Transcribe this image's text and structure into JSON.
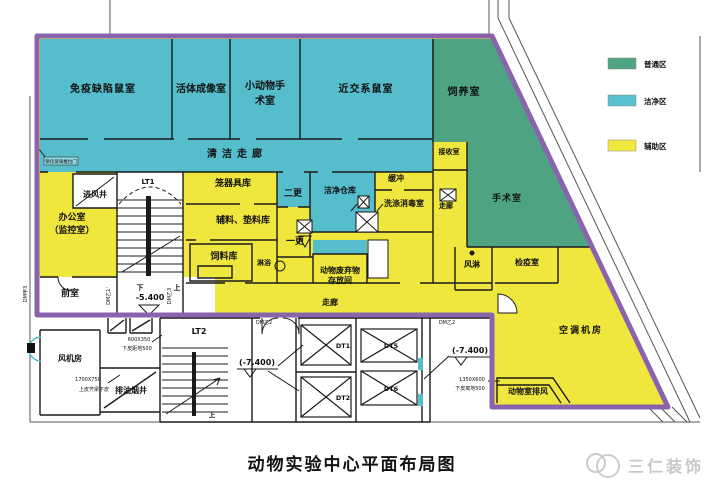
{
  "colors": {
    "boundary": "#8A63AD",
    "clean": "#55BDCB",
    "general": "#4EA383",
    "auxiliary": "#F0E73E",
    "wall": "#1a1a1a"
  },
  "legend": {
    "items": [
      {
        "label": "普通区",
        "color": "#4FA583"
      },
      {
        "label": "洁净区",
        "color": "#56C1CF"
      },
      {
        "label": "辅助区",
        "color": "#F2E83B"
      }
    ]
  },
  "title": "动物实验中心平面布局图",
  "watermark": "三仁装饰",
  "rooms": {
    "immuno": "免疫缺陷鼠室",
    "imaging": "活体成像室",
    "small_surgery_1": "小动物手",
    "small_surgery_2": "术室",
    "inbred": "近交系鼠室",
    "breeding": "饲养室",
    "clean_corridor": "清洁走廊",
    "receiving": "接收室",
    "air_inlet": "进风井",
    "office_1": "办公室",
    "office_2": "（监控室）",
    "cage_store": "笼器具库",
    "second_change": "二更",
    "clean_warehouse": "洁净仓库",
    "buffer": "缓冲",
    "washing": "洗涤消毒室",
    "corridor_recv": "走廊",
    "surgery": "手术室",
    "materials": "辅料、垫料库",
    "first_change": "一更",
    "feed_store": "饲料库",
    "shower": "淋浴",
    "waste_1": "动物废弃物",
    "waste_2": "存放间",
    "air_shower": "风淋",
    "quarantine": "检疫室",
    "corridor_main": "走廊",
    "anteroom": "前室",
    "ac_room": "空调机房",
    "animal_exhaust": "动物室排风",
    "fan_room": "风机房",
    "oil_shaft": "排油烟井",
    "lt1": "LT1",
    "lt2": "LT2",
    "dt1": "DT1",
    "dt2": "DT2",
    "dt5": "DT5",
    "dt6": "DT6"
  },
  "labels": {
    "elev_54": "-5.400",
    "elev_74a": "(-7.400)",
    "elev_74b": "(-7.400)",
    "down": "下",
    "up": "上",
    "up2": "上",
    "size_600": "600X350",
    "note_600": "下皮距地500",
    "size_1700": "1700X750",
    "note_1700": "上皮齐梁下皮",
    "size_1350": "1350X600",
    "note_1350": "下皮离地500",
    "dm_y2a": "DM乙2",
    "dm_y2b": "DM乙2",
    "dm_j3": "DM甲3",
    "dm_y1": "DM乙1'",
    "dm_y3": "DM乙3",
    "glass_note": "钢化玻璃推拉门"
  }
}
